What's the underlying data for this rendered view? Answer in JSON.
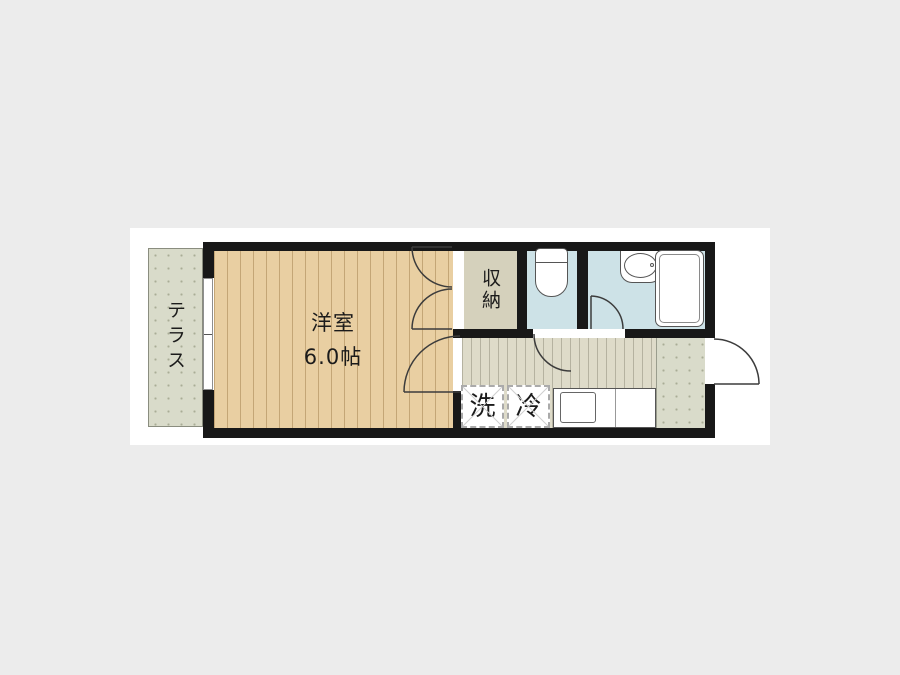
{
  "floor_plan": {
    "rooms": {
      "terrace_label": "テラス",
      "western_room_name": "洋室",
      "western_room_size": "6.0帖",
      "closet_label": "収納",
      "washer_label": "洗",
      "refrigerator_label": "冷"
    },
    "colors": {
      "page_background": "#ececec",
      "canvas_background": "#ffffff",
      "wall": "#181818",
      "wood_floor": "#e9cfa2",
      "wood_floor_stripe": "#c4a676",
      "terrace_fill": "#d9dbca",
      "closet_fill": "#d5d1bc",
      "wet_room_fill": "#cde2e7",
      "hallway_fill": "#dedbc9"
    }
  }
}
